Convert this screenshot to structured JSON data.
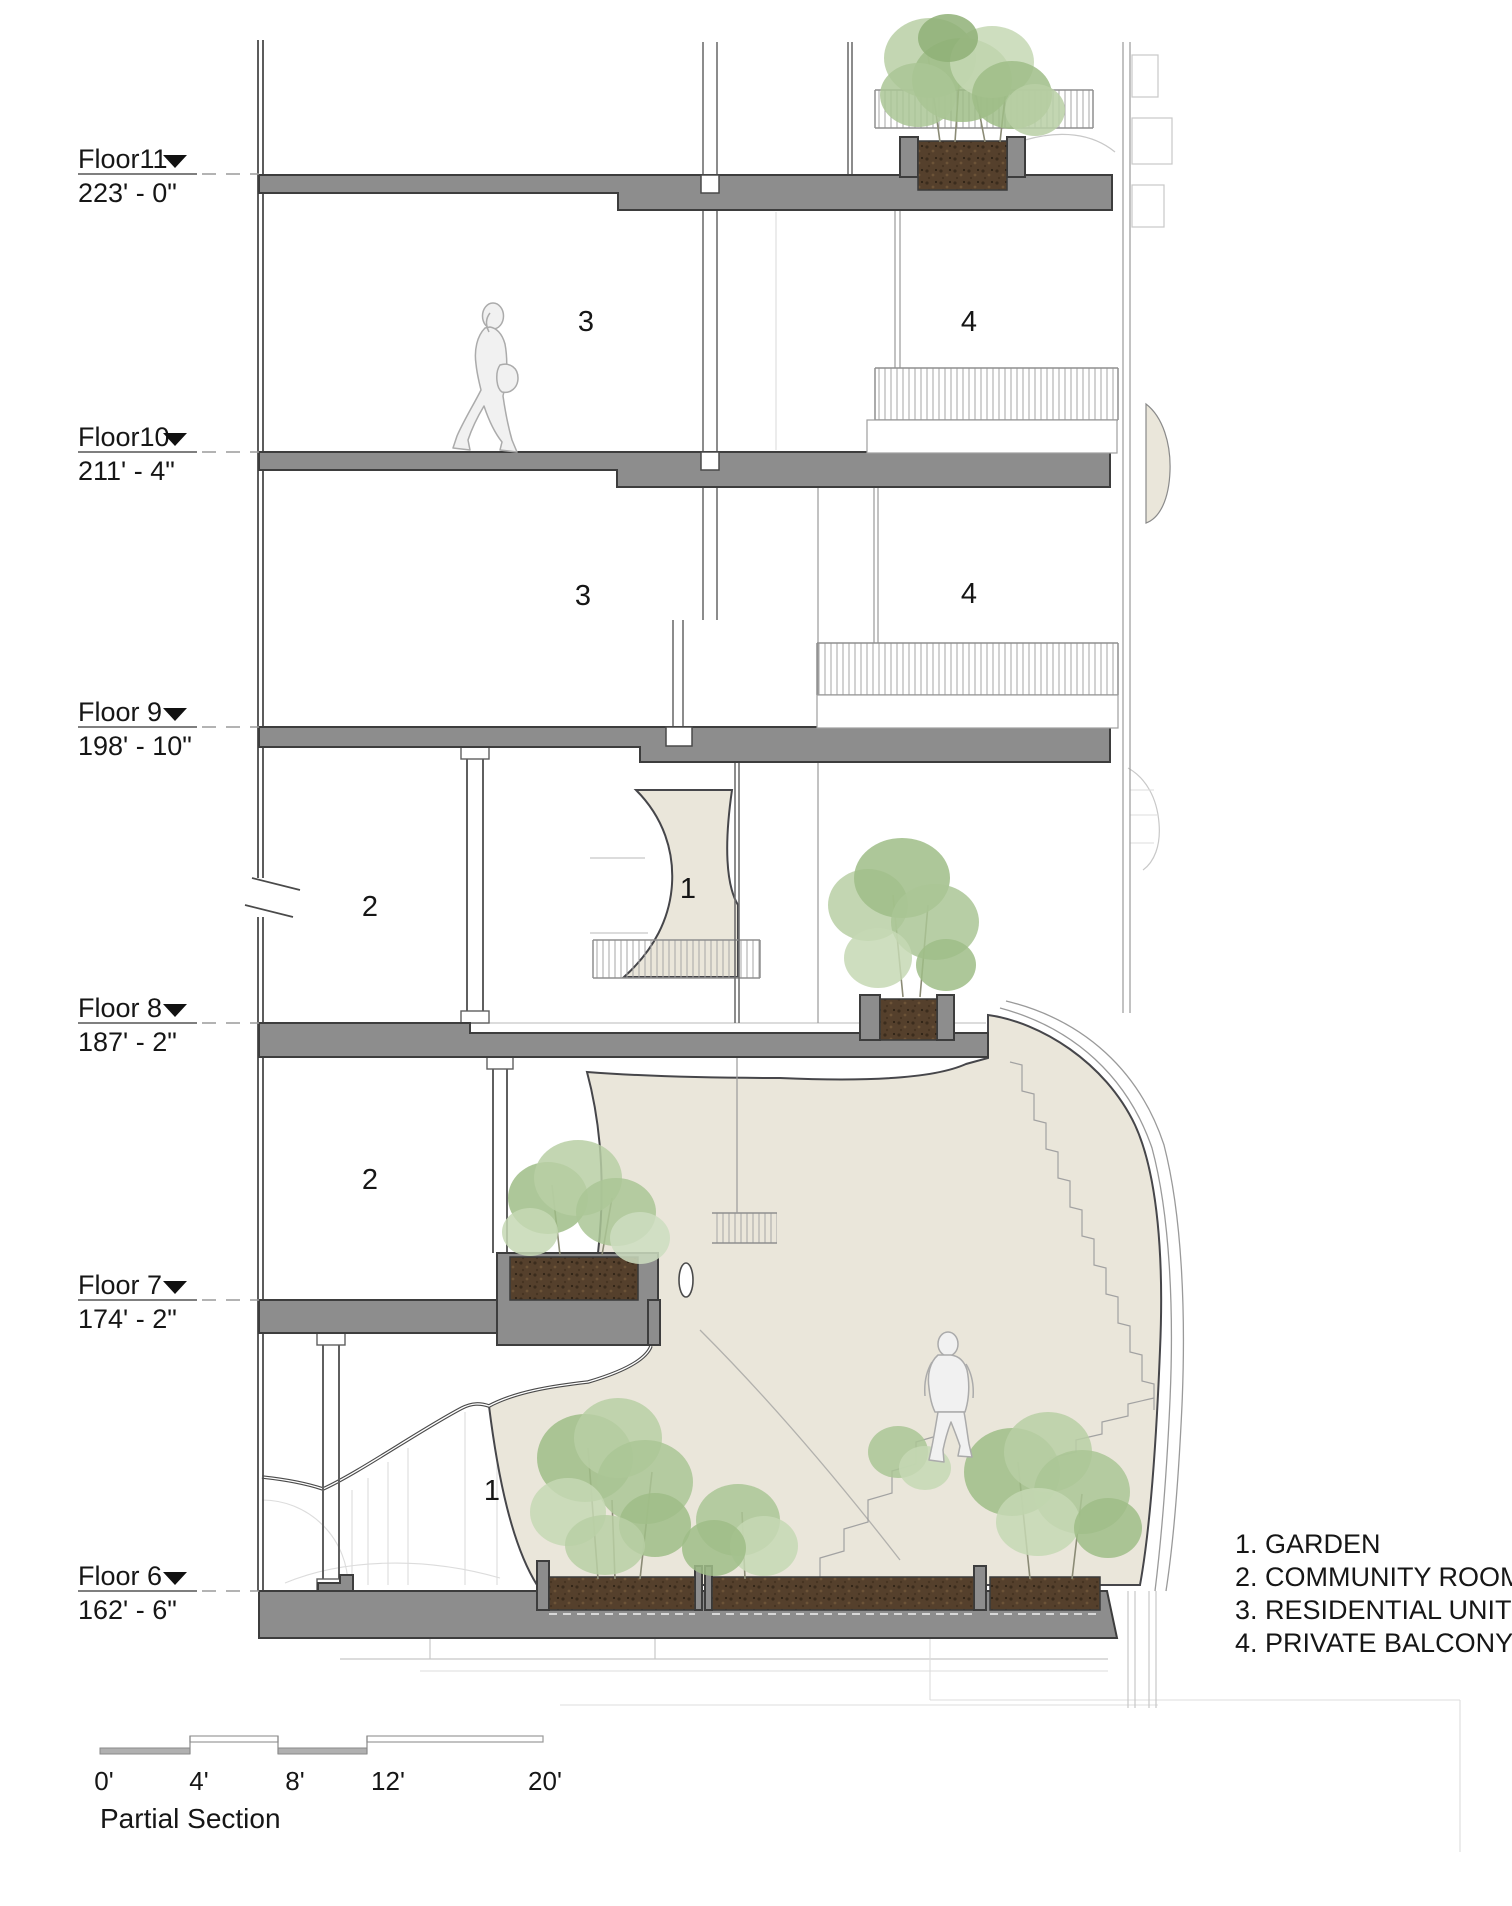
{
  "title": "Partial Section",
  "floors": [
    {
      "name": "Floor11",
      "elevation": "223' - 0\""
    },
    {
      "name": "Floor10",
      "elevation": "211' - 4\""
    },
    {
      "name": "Floor 9",
      "elevation": "198' - 10\""
    },
    {
      "name": "Floor 8",
      "elevation": "187' - 2\""
    },
    {
      "name": "Floor 7",
      "elevation": "174' - 2\""
    },
    {
      "name": "Floor 6",
      "elevation": "162' - 6\""
    }
  ],
  "legend": {
    "items": [
      "1. GARDEN",
      "2. COMMUNITY ROOM",
      "3. RESIDENTIAL UNIT",
      "4. PRIVATE BALCONY"
    ]
  },
  "annotations": [
    {
      "label": "3"
    },
    {
      "label": "4"
    },
    {
      "label": "3"
    },
    {
      "label": "4"
    },
    {
      "label": "2"
    },
    {
      "label": "1"
    },
    {
      "label": "2"
    },
    {
      "label": "1"
    }
  ],
  "scale_bar": {
    "labels": [
      "0'",
      "4'",
      "8'",
      "12'",
      "20'"
    ]
  },
  "colors": {
    "slab_gray": "#8d8d8d",
    "atrium_beige": "#eae6da",
    "soil_brown": "#55402c",
    "foliage_green": "#9fbd87",
    "linework_dark": "#3d3d3d"
  }
}
